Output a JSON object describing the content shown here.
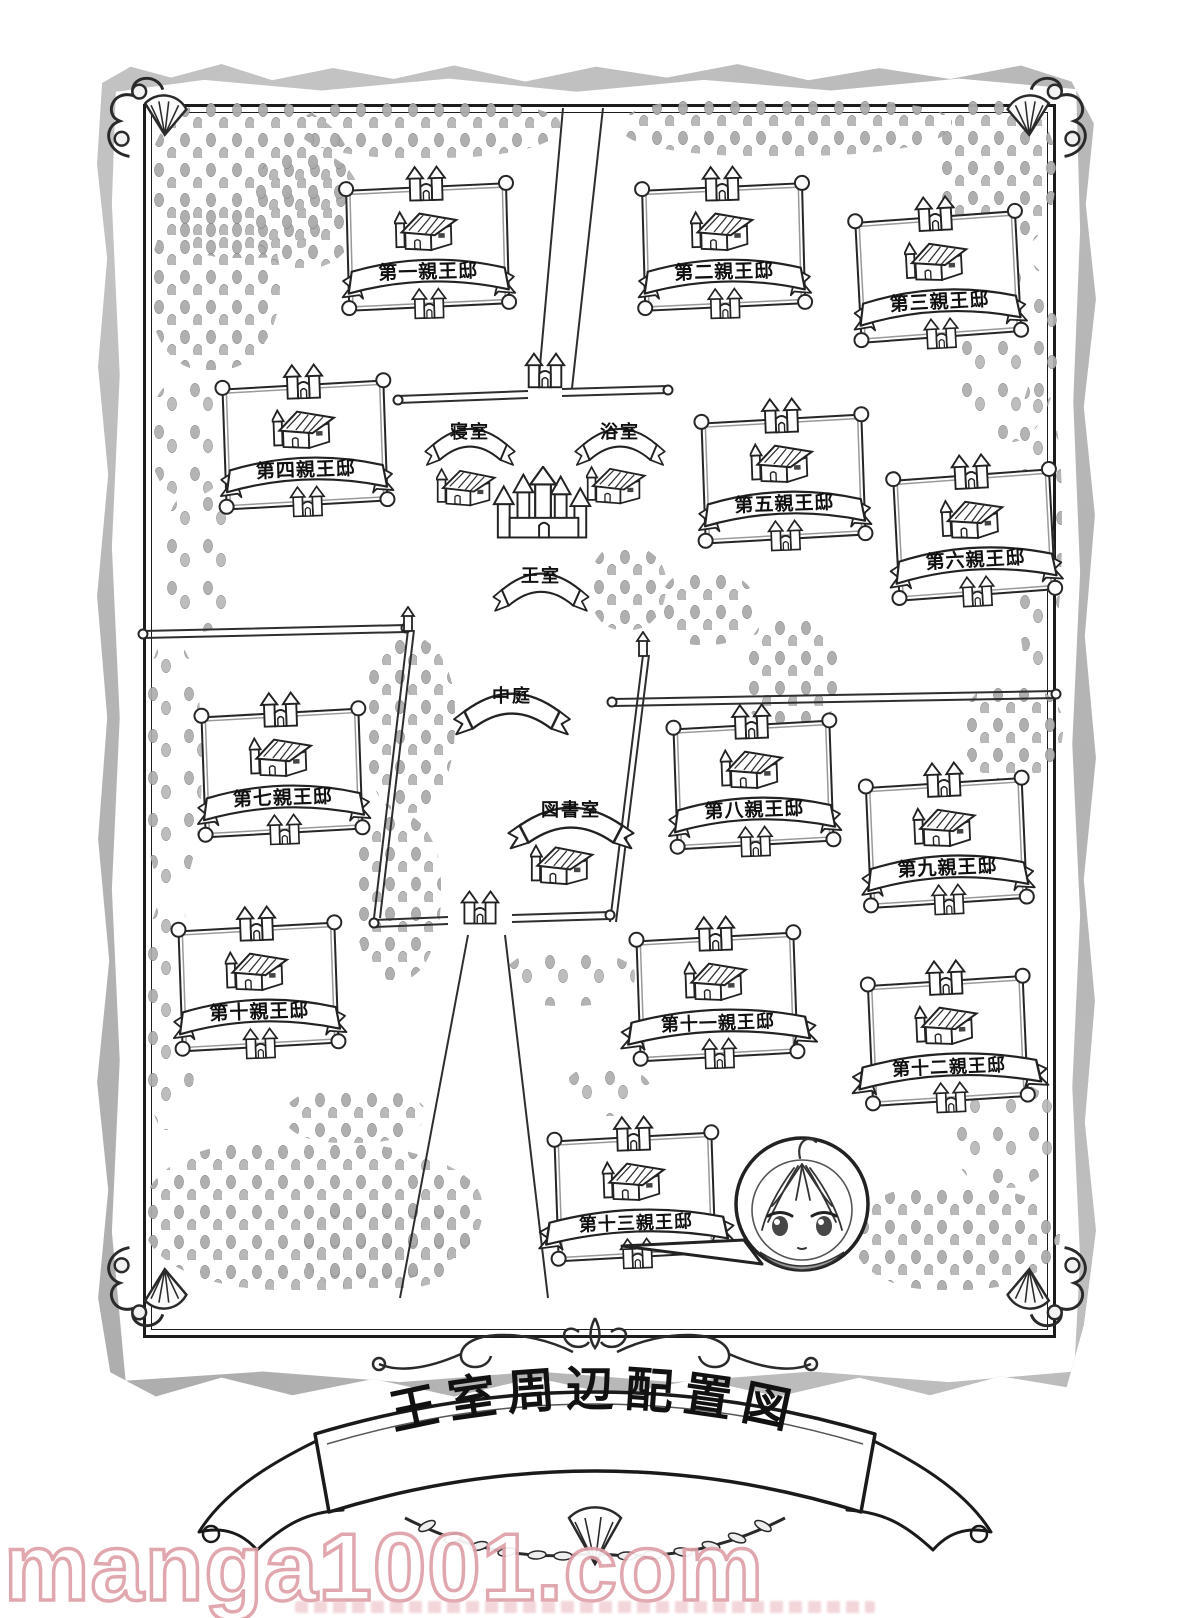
{
  "page": {
    "watermark": "manga1001.com"
  },
  "map": {
    "title": "王室周辺配置図",
    "estates": [
      {
        "label": "第一親王邸"
      },
      {
        "label": "第二親王邸"
      },
      {
        "label": "第三親王邸"
      },
      {
        "label": "第四親王邸"
      },
      {
        "label": "第五親王邸"
      },
      {
        "label": "第六親王邸"
      },
      {
        "label": "第七親王邸"
      },
      {
        "label": "第八親王邸"
      },
      {
        "label": "第九親王邸"
      },
      {
        "label": "第十親王邸"
      },
      {
        "label": "第十一親王邸"
      },
      {
        "label": "第十二親王邸"
      },
      {
        "label": "第十三親王邸"
      }
    ],
    "places": {
      "bedroom": "寝室",
      "bathroom": "浴室",
      "royal_room": "王室",
      "courtyard": "中庭",
      "library": "図書室"
    }
  }
}
